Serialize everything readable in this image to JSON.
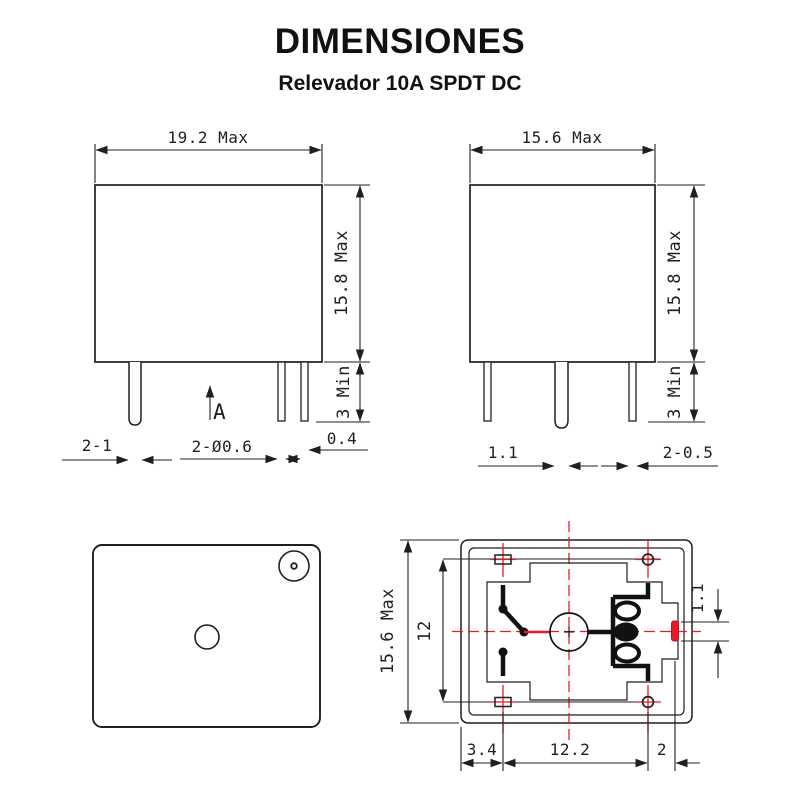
{
  "header": {
    "title": "DIMENSIONES",
    "subtitle": "Relevador 10A SPDT DC"
  },
  "colors": {
    "line": "#1f1f1f",
    "accent_red": "#e8192a",
    "background": "#ffffff"
  },
  "views": {
    "front": {
      "labels": {
        "width": "19.2 Max",
        "height": "15.8 Max",
        "pin_length": "3 Min",
        "pin_pair": "2-1",
        "pin_diameter": "2-Ø0.6",
        "pin_thickness": "0.4",
        "section": "A"
      }
    },
    "side": {
      "labels": {
        "width": "15.6 Max",
        "height": "15.8 Max",
        "pin_length": "3 Min",
        "pin_width": "1.1",
        "pin_pair_thickness": "2-0.5"
      }
    },
    "bottom": {
      "labels": {
        "height": "15.6 Max",
        "pin_row_spacing": "12",
        "coil_pin_width": "1.1",
        "edge_offset": "3.4",
        "pin_column_spacing": "12.2",
        "coil_pin_offset": "2"
      }
    }
  }
}
